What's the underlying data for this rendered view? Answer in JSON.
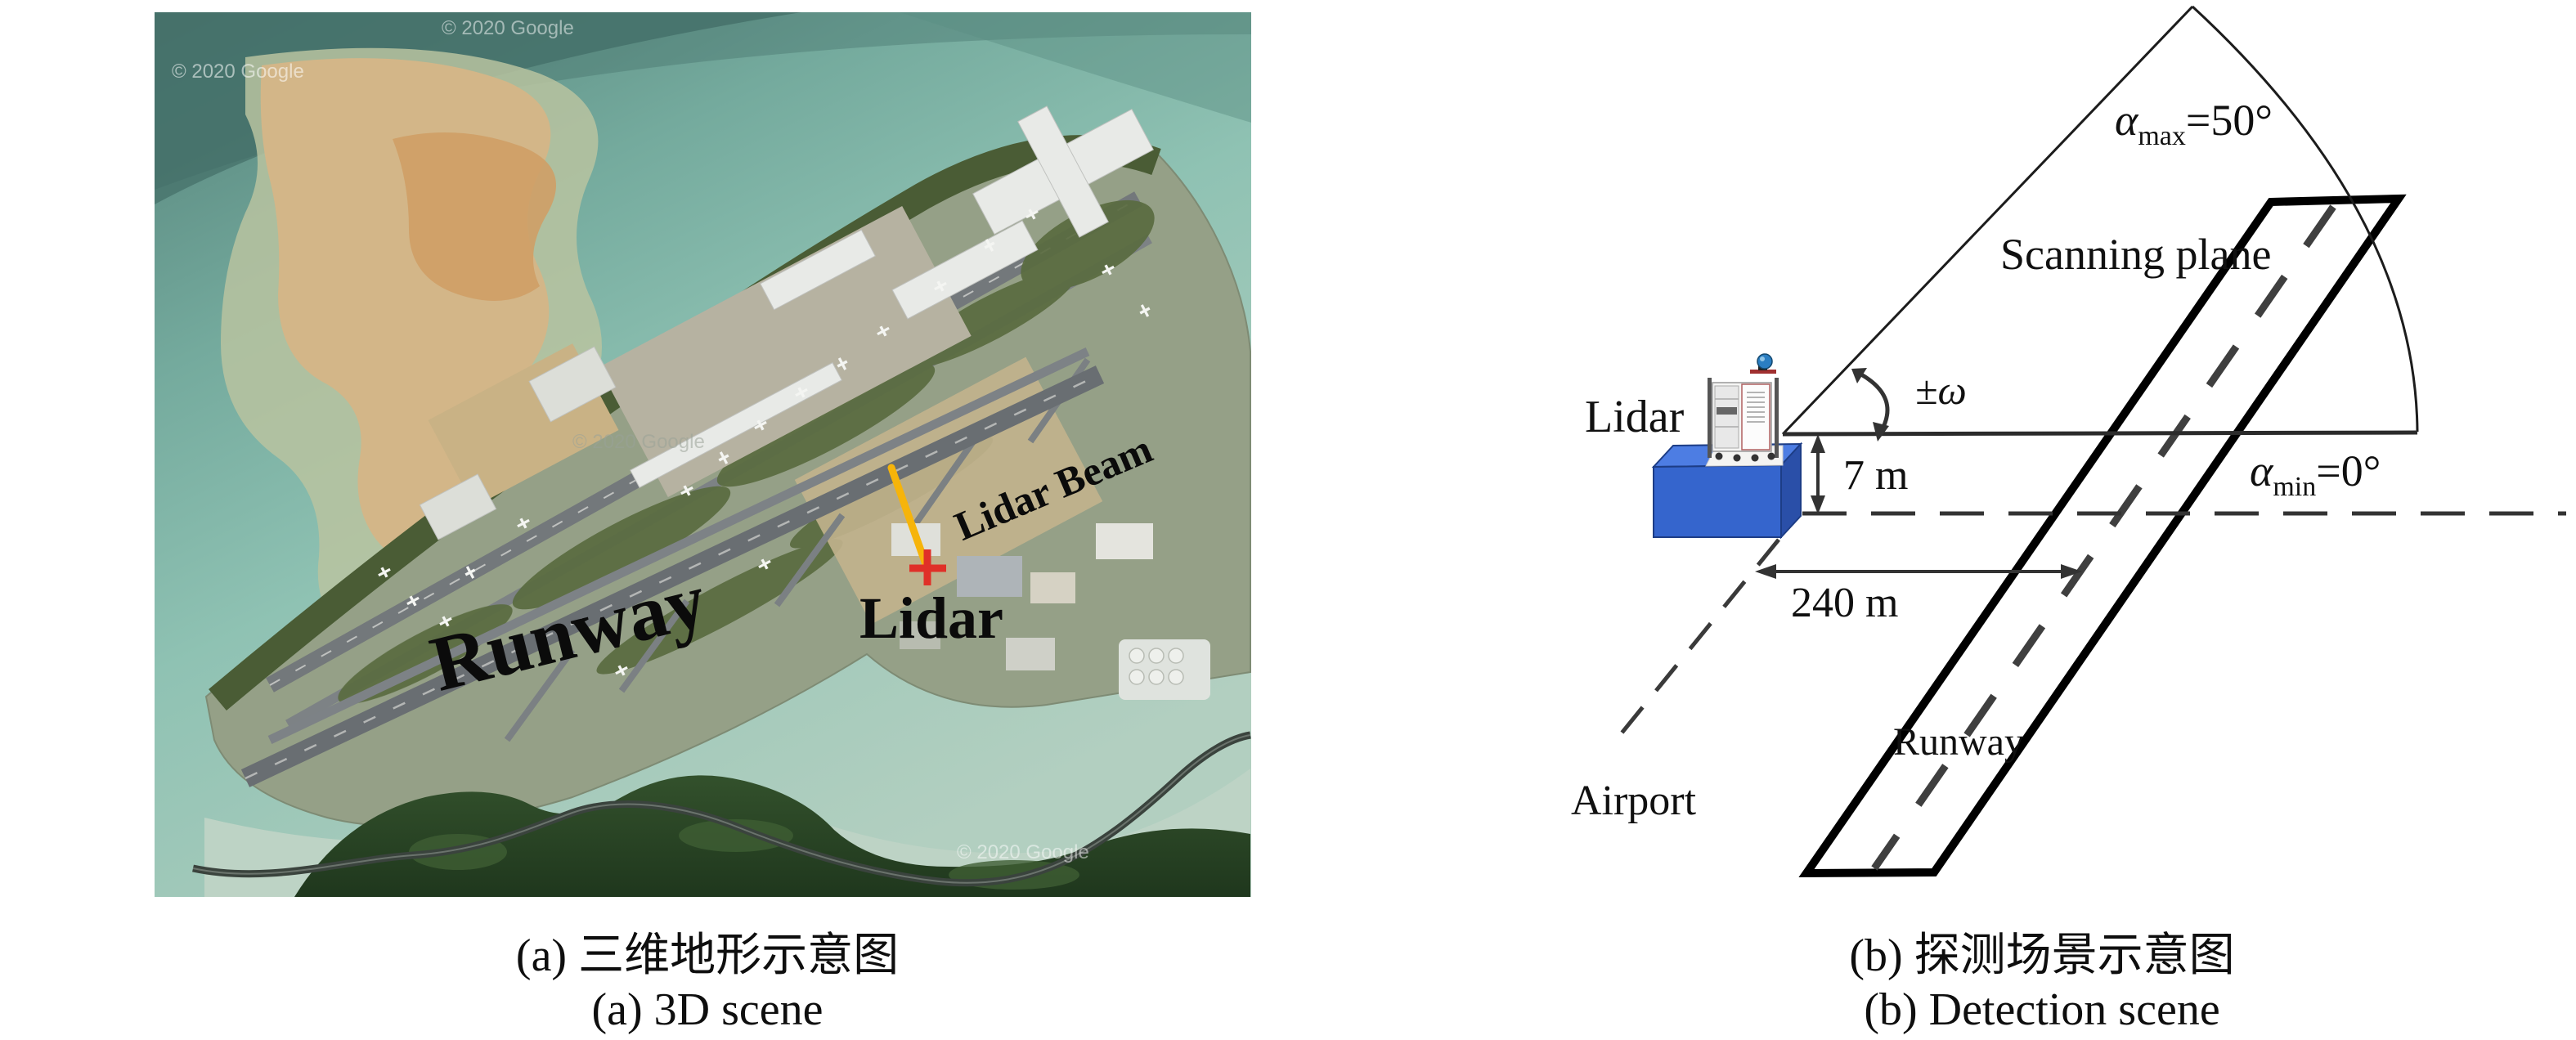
{
  "figure": {
    "panel_a": {
      "map_labels": {
        "runway": "Runway",
        "lidar": "Lidar",
        "lidar_beam": "Lidar Beam"
      },
      "watermark": "© 2020 Google",
      "caption_zh": "(a) 三维地形示意图",
      "caption_en": "(a) 3D scene"
    },
    "panel_b": {
      "labels": {
        "lidar": "Lidar",
        "scanning_plane": "Scanning plane",
        "alpha_max": {
          "alpha": "α",
          "sub": "max",
          "eq": "=50°"
        },
        "alpha_min": {
          "alpha": "α",
          "sub": "min",
          "eq": "=0°"
        },
        "omega": "±ω",
        "height": "7 m",
        "distance": "240 m",
        "runway": "Runway",
        "airport": "Airport"
      },
      "caption_zh": "(b) 探测场景示意图",
      "caption_en": "(b) Detection scene"
    },
    "colors": {
      "beam_yellow": "#f6b40a",
      "marker_red": "#e03028",
      "box_blue": "#3565cd",
      "sea_teal": "#8fc2b3"
    }
  }
}
